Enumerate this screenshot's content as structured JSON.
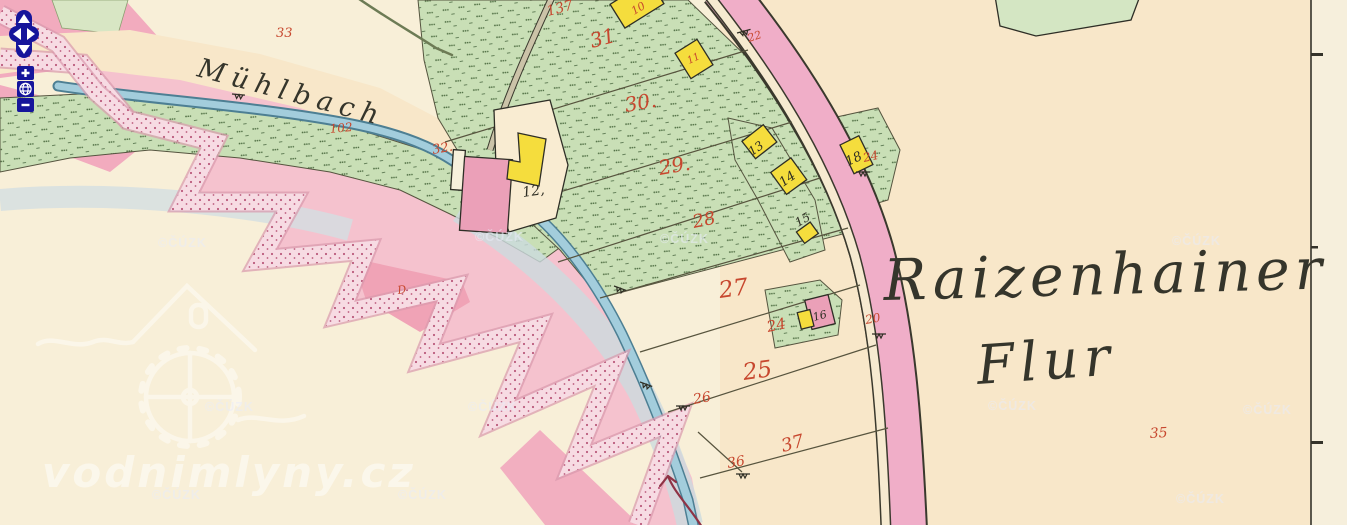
{
  "map": {
    "territory_label": {
      "line1": "Raizenhainer",
      "line2": "Flur"
    },
    "stream_label": "Mühlbach",
    "watermarks": {
      "copyright": "©ČÚZK",
      "site": "vodnimlyny.cz"
    },
    "copyright_watermarks": [
      {
        "x": 158,
        "y": 247
      },
      {
        "x": 475,
        "y": 241
      },
      {
        "x": 660,
        "y": 243
      },
      {
        "x": 1172,
        "y": 245
      },
      {
        "x": 205,
        "y": 411
      },
      {
        "x": 468,
        "y": 411
      },
      {
        "x": 988,
        "y": 410
      },
      {
        "x": 1243,
        "y": 414
      },
      {
        "x": 152,
        "y": 499
      },
      {
        "x": 398,
        "y": 499
      },
      {
        "x": 1176,
        "y": 503
      }
    ],
    "labels": [
      {
        "text": "33",
        "x": 276,
        "y": 37,
        "size": 13,
        "rot": 0,
        "cls": "red",
        "name": "parcel-number-33"
      },
      {
        "text": "137",
        "x": 548,
        "y": 16,
        "size": 14,
        "rot": -15,
        "cls": "red",
        "name": "parcel-number-137"
      },
      {
        "text": "31",
        "x": 592,
        "y": 48,
        "size": 20,
        "rot": -15,
        "cls": "red",
        "name": "parcel-number-31"
      },
      {
        "text": "30.",
        "x": 626,
        "y": 112,
        "size": 20,
        "rot": -10,
        "cls": "red",
        "name": "parcel-number-30"
      },
      {
        "text": "29.",
        "x": 660,
        "y": 175,
        "size": 20,
        "rot": -10,
        "cls": "red",
        "name": "parcel-number-29"
      },
      {
        "text": "28",
        "x": 694,
        "y": 228,
        "size": 18,
        "rot": -12,
        "cls": "red",
        "name": "parcel-number-28"
      },
      {
        "text": "27",
        "x": 720,
        "y": 298,
        "size": 23,
        "rot": -8,
        "cls": "red",
        "name": "parcel-number-27"
      },
      {
        "text": "25",
        "x": 744,
        "y": 380,
        "size": 23,
        "rot": -8,
        "cls": "red",
        "name": "parcel-number-25"
      },
      {
        "text": "37",
        "x": 783,
        "y": 452,
        "size": 18,
        "rot": -15,
        "cls": "red",
        "name": "parcel-number-37"
      },
      {
        "text": "36",
        "x": 728,
        "y": 468,
        "size": 14,
        "rot": -10,
        "cls": "red",
        "name": "parcel-number-36"
      },
      {
        "text": "26",
        "x": 694,
        "y": 404,
        "size": 14,
        "rot": -10,
        "cls": "red",
        "name": "parcel-number-26"
      },
      {
        "text": "24",
        "x": 768,
        "y": 332,
        "size": 15,
        "rot": -12,
        "cls": "red",
        "name": "parcel-number-24"
      },
      {
        "text": "24",
        "x": 864,
        "y": 162,
        "size": 12,
        "rot": -12,
        "cls": "red",
        "name": "parcel-number-24b"
      },
      {
        "text": "20",
        "x": 866,
        "y": 324,
        "size": 12,
        "rot": -10,
        "cls": "red",
        "name": "parcel-number-20"
      },
      {
        "text": "22",
        "x": 749,
        "y": 42,
        "size": 11,
        "rot": -18,
        "cls": "red",
        "name": "parcel-number-22"
      },
      {
        "text": "102",
        "x": 330,
        "y": 133,
        "size": 12,
        "rot": -5,
        "cls": "red",
        "name": "parcel-number-102"
      },
      {
        "text": "32.",
        "x": 433,
        "y": 154,
        "size": 13,
        "rot": -10,
        "cls": "red",
        "name": "parcel-number-32"
      },
      {
        "text": "35",
        "x": 1150,
        "y": 438,
        "size": 14,
        "rot": -3,
        "cls": "red",
        "name": "parcel-number-35"
      },
      {
        "text": "10",
        "x": 634,
        "y": 15,
        "size": 11,
        "rot": -30,
        "cls": "red",
        "name": "building-number-10"
      },
      {
        "text": "11",
        "x": 689,
        "y": 64,
        "size": 10,
        "rot": -25,
        "cls": "red",
        "name": "building-number-11"
      },
      {
        "text": "D",
        "x": 398,
        "y": 294,
        "size": 11,
        "rot": -8,
        "cls": "red",
        "name": "boundary-mark-d"
      },
      {
        "text": "12,",
        "x": 523,
        "y": 197,
        "size": 14,
        "rot": -8,
        "cls": "black",
        "name": "building-number-12"
      },
      {
        "text": "13",
        "x": 752,
        "y": 156,
        "size": 12,
        "rot": -35,
        "cls": "black",
        "name": "building-number-13"
      },
      {
        "text": "14",
        "x": 783,
        "y": 187,
        "size": 13,
        "rot": -35,
        "cls": "black",
        "name": "building-number-14"
      },
      {
        "text": "15",
        "x": 798,
        "y": 227,
        "size": 12,
        "rot": -30,
        "cls": "black",
        "name": "building-number-15"
      },
      {
        "text": "18",
        "x": 848,
        "y": 166,
        "size": 13,
        "rot": -25,
        "cls": "black",
        "name": "building-number-18"
      },
      {
        "text": "16",
        "x": 814,
        "y": 321,
        "size": 11,
        "rot": -15,
        "cls": "black",
        "name": "building-number-16"
      }
    ],
    "colors": {
      "paper": "#f8e7c9",
      "paper_right": "#f6efdc",
      "interior": "#f8efd8",
      "meadow_green": "#c9dfb6",
      "road_pink": "#f0aec8",
      "band_pink": "#f7dbe3",
      "area_pink": "#f5c2ce",
      "stream_blue": "#a3cddc",
      "building_yellow": "#f5dd3d",
      "building_pink": "#eba0b8",
      "number_red": "#c7472e",
      "ink": "#2f2e24",
      "control_navy": "#16159b"
    }
  },
  "controls": {
    "pan_up": "pan up",
    "pan_down": "pan down",
    "pan_left": "pan left",
    "pan_right": "pan right",
    "zoom_in_label": "+",
    "zoom_out_label": "−",
    "zoom_world": "zoom to extent"
  }
}
